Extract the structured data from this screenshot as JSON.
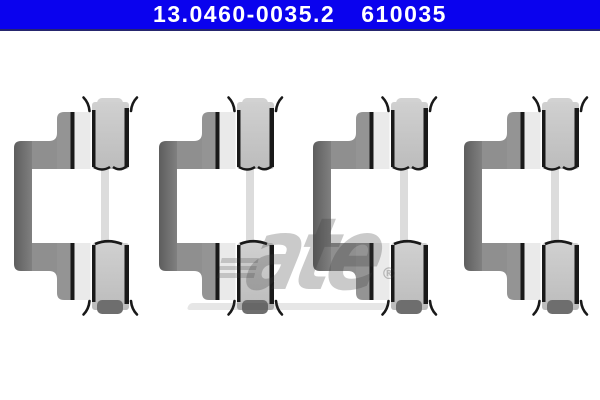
{
  "header": {
    "part_number": "13.0460-0035.2",
    "reference_number": "610035",
    "background_color": "#0a02ee",
    "border_color": "#26266e",
    "text_color": "#ffffff"
  },
  "watermark": {
    "brand_text": "ate",
    "registered_symbol": "®",
    "color": "#c9c9c9"
  },
  "product": {
    "item": "brake-pad-retaining-clip",
    "count": 4,
    "background": "#ffffff",
    "colors": {
      "bracket_gray": "#8f8f8f",
      "spine_gray": "#5d5d5d",
      "slot_light": "#eaeaea",
      "pad_box_gray": "#c3c3c3",
      "edge_black": "#191919",
      "foot_tab_dark": "#6e6e6e"
    }
  }
}
